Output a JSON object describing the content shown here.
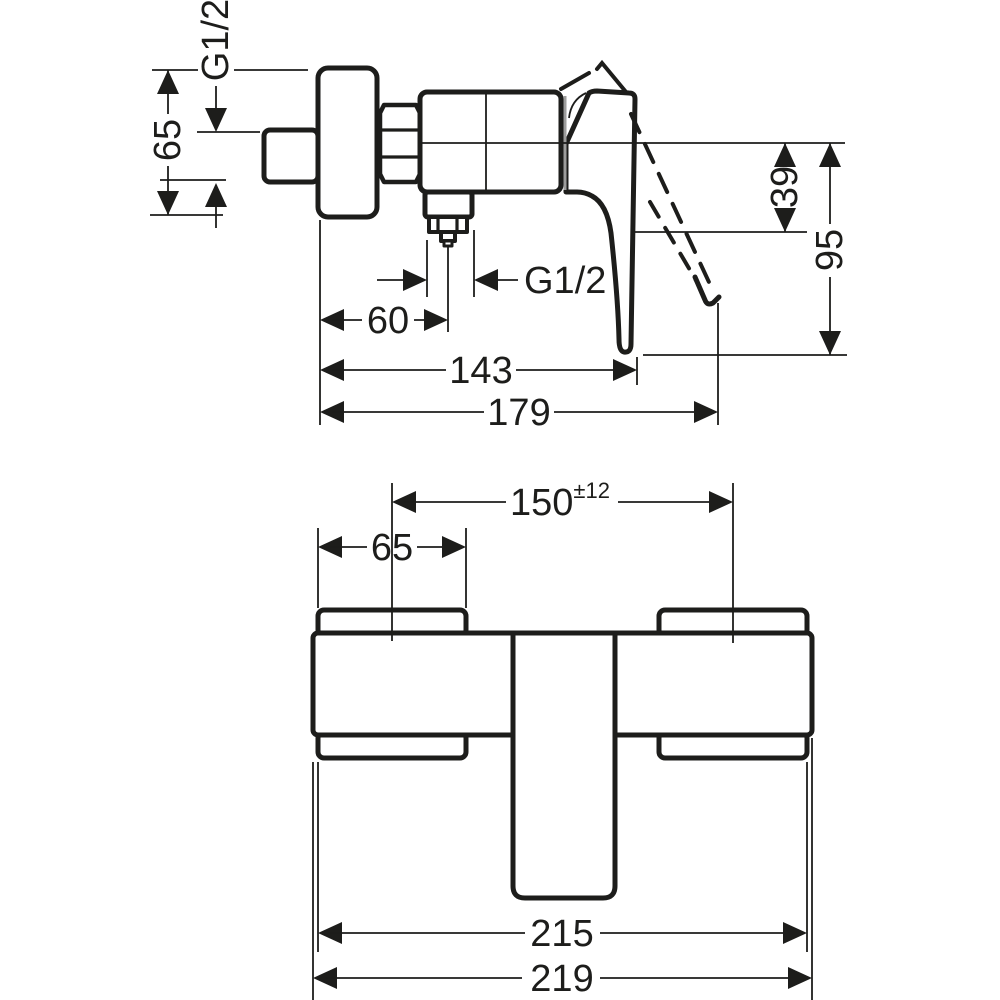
{
  "drawing": {
    "kind": "shower-mixer-installation-dimension-drawing",
    "colors": {
      "line": "#1d1d1b",
      "joint_line": "#9d9d9c",
      "background": "#ffffff"
    },
    "side_view": {
      "dimensions": {
        "wall_connection_thread": "G1/2",
        "escutcheon_size": "65",
        "outlet_thread": "G1/2",
        "wall_to_outlet_center": "60",
        "wall_to_handle_tip": "143",
        "overall_depth": "179",
        "centerline_to_body_bottom": "39",
        "centerline_to_handle_end": "95"
      }
    },
    "front_view": {
      "dimensions": {
        "connection_centers": "150",
        "connection_centers_tolerance": "±12",
        "escutcheon_width": "65",
        "body_width": "215",
        "overall_width": "219"
      }
    }
  }
}
